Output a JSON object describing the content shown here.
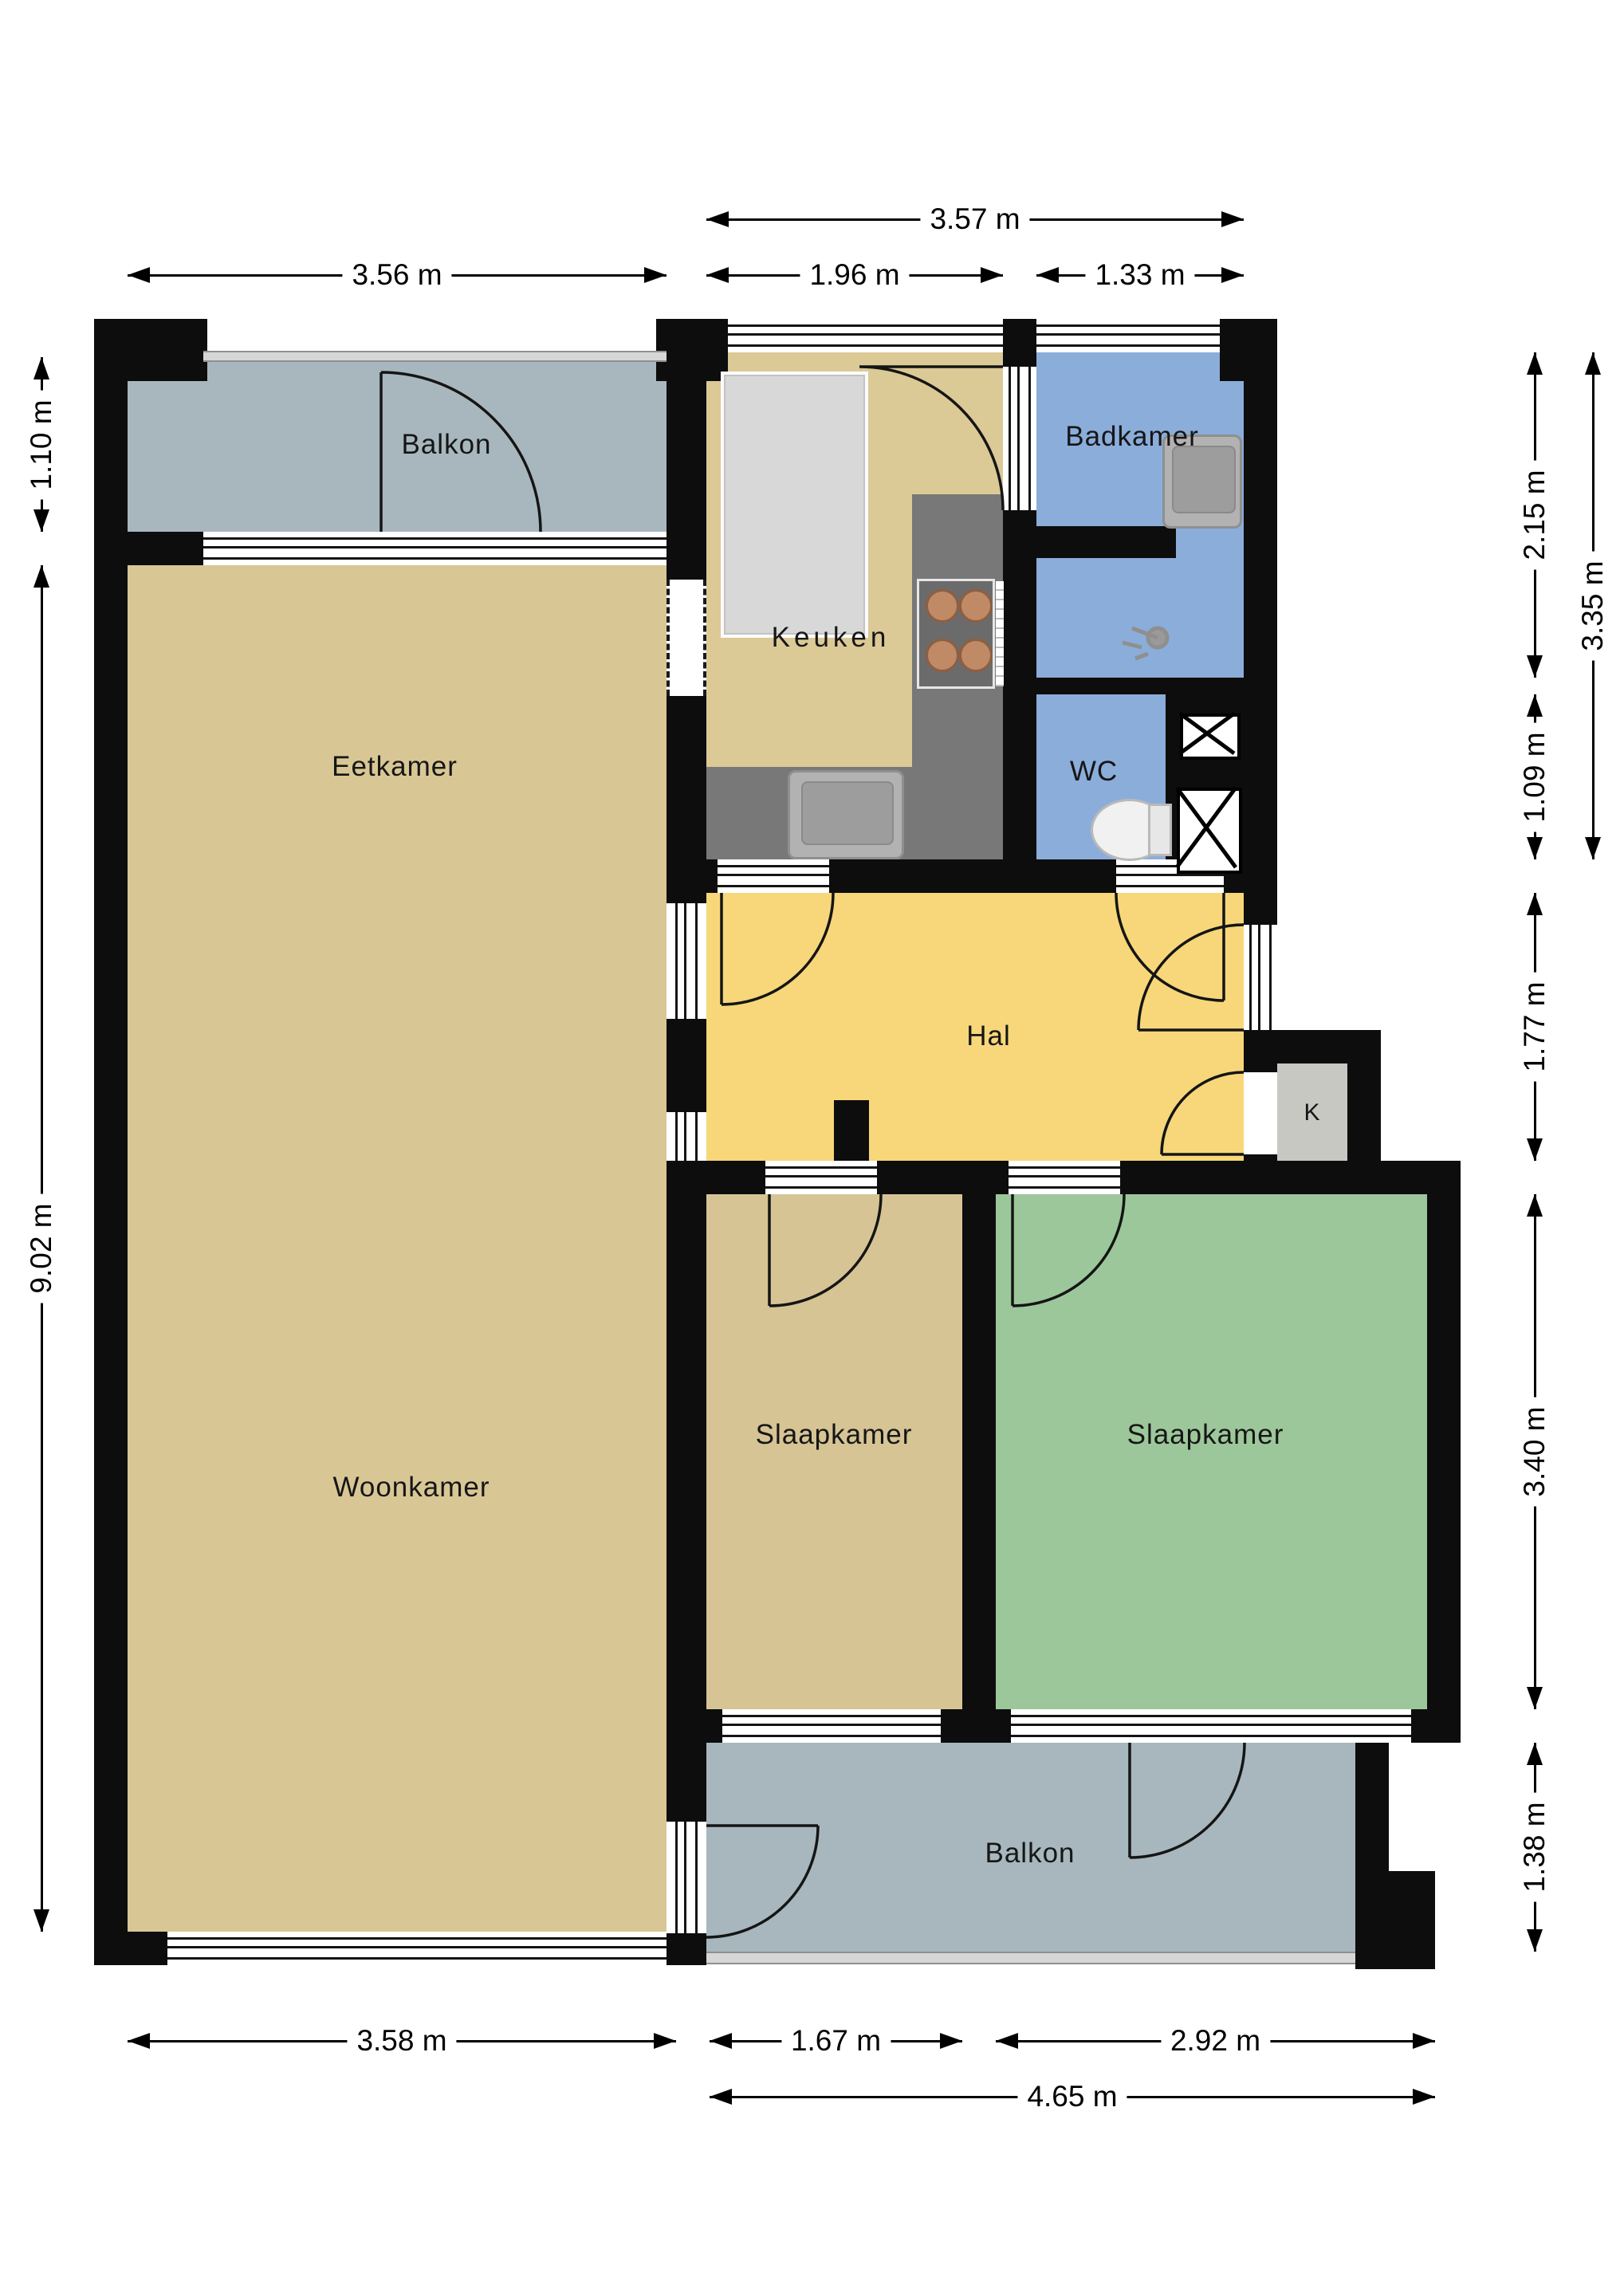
{
  "plan_title": "Floor plan apartment",
  "rooms": {
    "balkon_top": {
      "label": "Balkon",
      "color": "#a8b7be"
    },
    "eetkamer": {
      "label": "Eetkamer",
      "color": "#d8c795"
    },
    "woonkamer": {
      "label": "Woonkamer",
      "color": "#d8c795"
    },
    "keuken": {
      "label": "Keuken",
      "color": "#dbc996"
    },
    "badkamer": {
      "label": "Badkamer",
      "color": "#8badda"
    },
    "wc": {
      "label": "WC",
      "color": "#8badda"
    },
    "hal": {
      "label": "Hal",
      "color": "#f7d77a"
    },
    "kast": {
      "label": "K",
      "color": "#c8c8c3"
    },
    "slaapkamer_1": {
      "label": "Slaapkamer",
      "color": "#d6c495"
    },
    "slaapkamer_2": {
      "label": "Slaapkamer",
      "color": "#9cc79a"
    },
    "balkon_bottom": {
      "label": "Balkon",
      "color": "#a8b7be"
    }
  },
  "dimensions": {
    "top_total": "3.57 m",
    "top_left": "3.56 m",
    "top_keuken": "1.96 m",
    "top_badkamer": "1.33 m",
    "left_balkon": "1.10 m",
    "left_main": "9.02 m",
    "right_badkamer": "2.15 m",
    "right_total_top": "3.35 m",
    "right_wc": "1.09 m",
    "right_hal": "1.77 m",
    "right_slaapkamer": "3.40 m",
    "right_balkon": "1.38 m",
    "bottom_woonkamer": "3.58 m",
    "bottom_slaapkamer1": "1.67 m",
    "bottom_slaapkamer2": "2.92 m",
    "bottom_total": "4.65 m"
  },
  "fixtures": [
    "fridge-icon",
    "counter-icon",
    "stove-icon",
    "kitchen-sink-icon",
    "bathroom-sink-icon",
    "shower-icon",
    "toilet-icon",
    "shaft-x-icon",
    "door-arc-icon",
    "window-icon"
  ],
  "colors": {
    "wall": "#0d0d0d",
    "window_line": "#141414",
    "railing": "#d6d6d6",
    "counter": "#787878",
    "background": "#ffffff"
  }
}
